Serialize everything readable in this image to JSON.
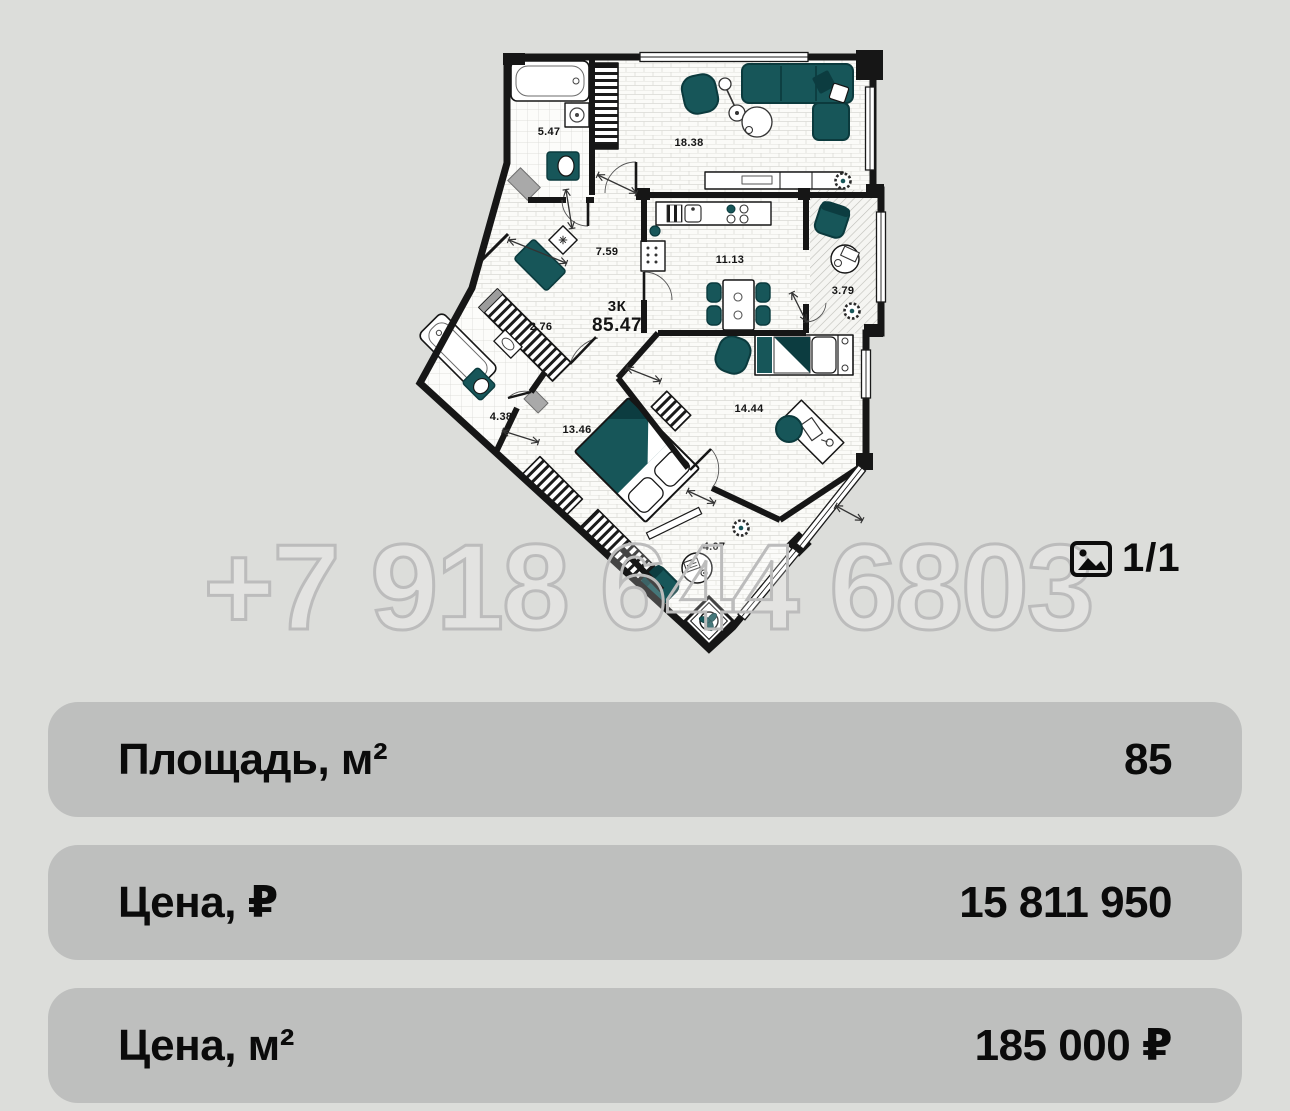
{
  "watermark": {
    "phone": "+7 918 644 6803"
  },
  "gallery": {
    "counter": "1/1"
  },
  "plan": {
    "flat_type": "3К",
    "total_area": "85.47",
    "rooms": [
      {
        "name": "bathroom",
        "area": "5.47"
      },
      {
        "name": "living-room",
        "area": "18.38"
      },
      {
        "name": "hallway",
        "area": "7.59"
      },
      {
        "name": "kitchen",
        "area": "11.13"
      },
      {
        "name": "loggia",
        "area": "3.79"
      },
      {
        "name": "wardrobe",
        "area": "2.76"
      },
      {
        "name": "bathroom-2",
        "area": "4.38"
      },
      {
        "name": "bedroom",
        "area": "13.46"
      },
      {
        "name": "bedroom-2",
        "area": "14.44"
      },
      {
        "name": "loggia-2",
        "area": "4.07"
      }
    ],
    "colors": {
      "furniture": "#175659",
      "walls": "#161616",
      "floor": "#fbfbf9"
    }
  },
  "details": {
    "rows": [
      {
        "label": "Площадь, м²",
        "value": "85"
      },
      {
        "label": "Цена, ₽",
        "value": "15 811 950"
      },
      {
        "label": "Цена, м²",
        "value": "185 000 ₽"
      }
    ]
  }
}
